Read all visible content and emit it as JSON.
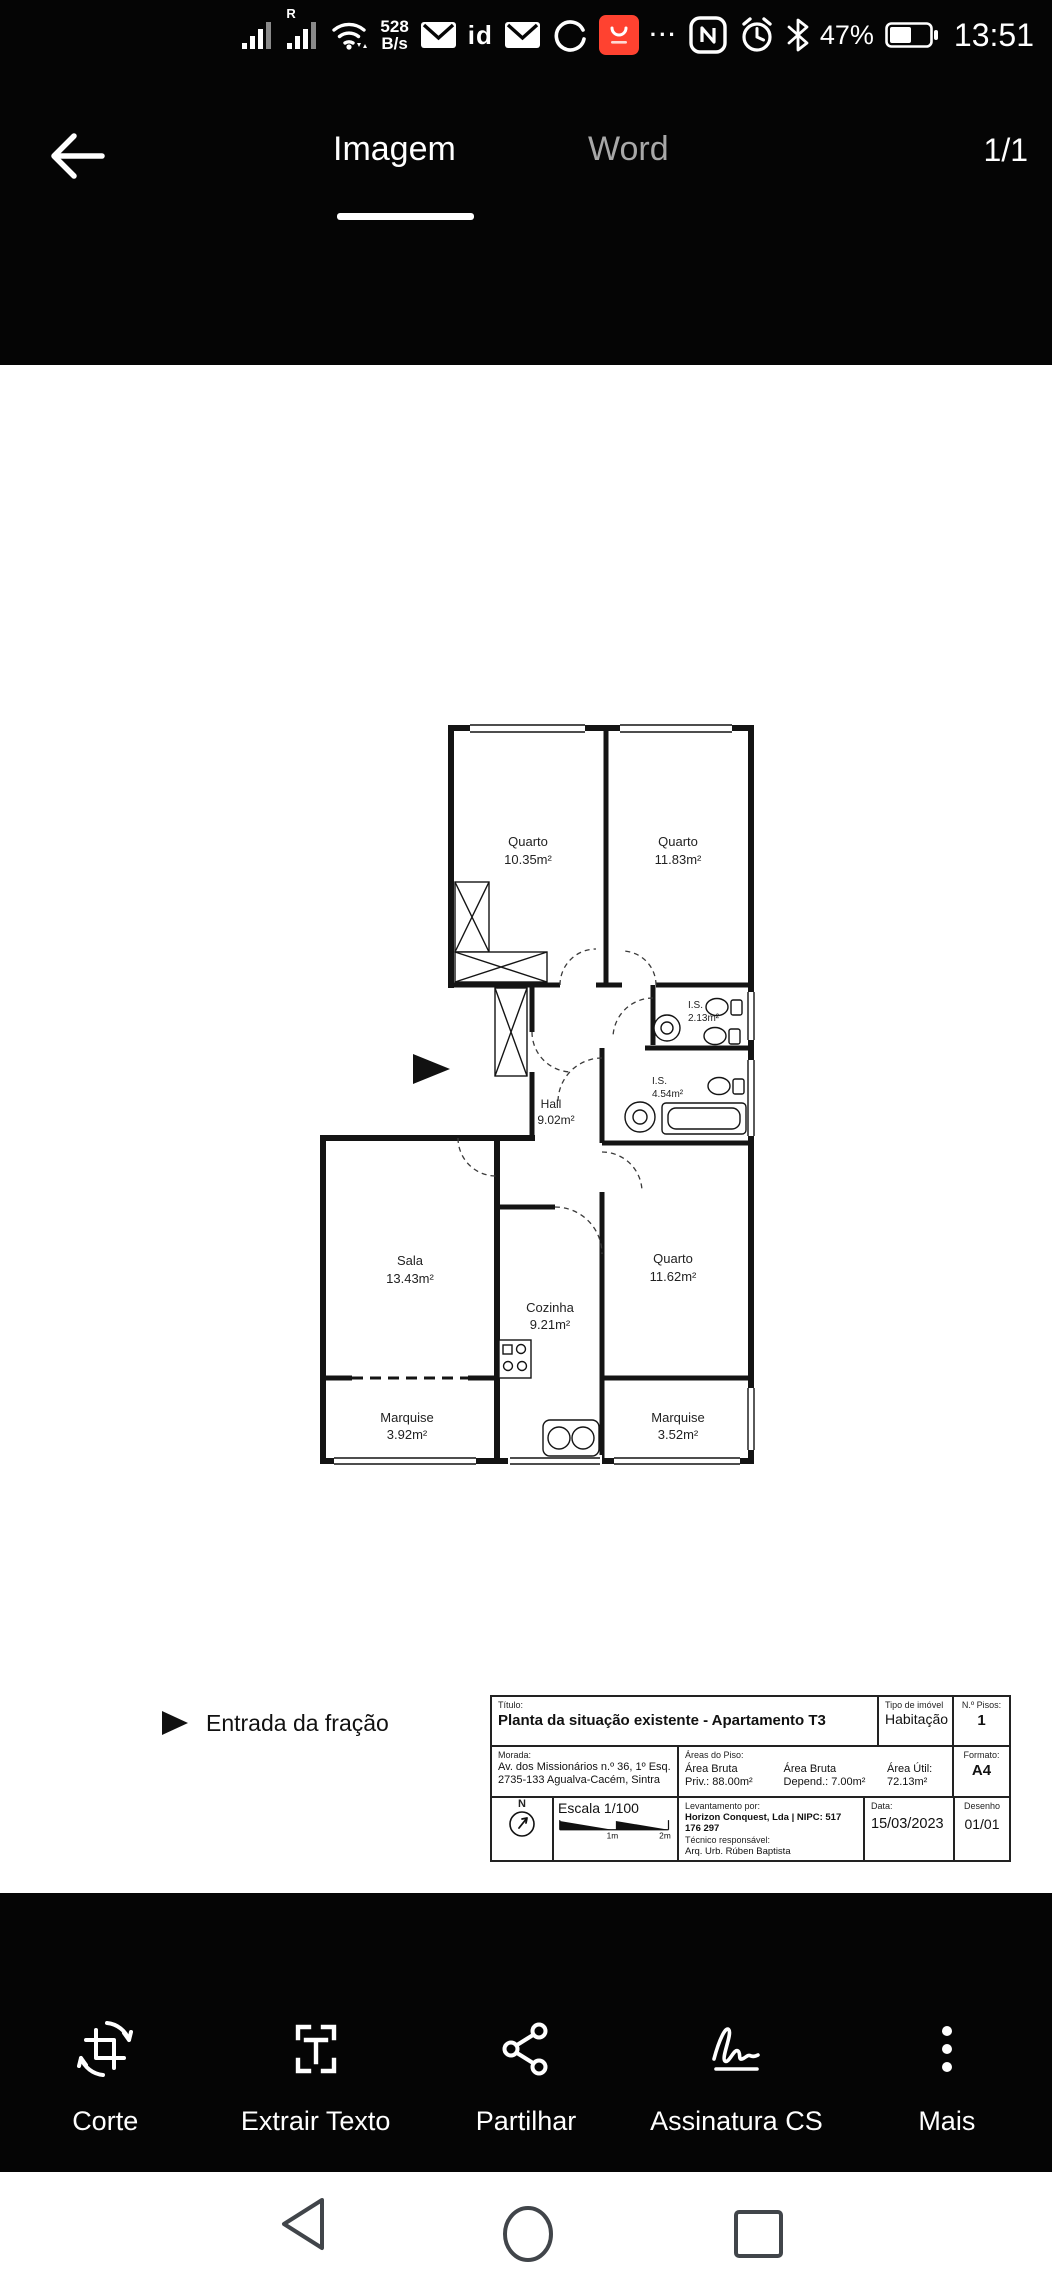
{
  "status_bar": {
    "carrier_indicator": "R",
    "network_speed_value": "528",
    "network_speed_unit": "B/s",
    "id_label": "id",
    "ellipsis": "···",
    "battery_percent": "47%",
    "time": "13:51",
    "aliexpress_color": "#ff4230"
  },
  "header": {
    "tabs": [
      {
        "label": "Imagem",
        "active": true
      },
      {
        "label": "Word",
        "active": false
      }
    ],
    "page_indicator": "1/1"
  },
  "floorplan": {
    "entrance_label": "Entrada da fração",
    "rooms": [
      {
        "name": "Quarto",
        "area": "10.35m²"
      },
      {
        "name": "Quarto",
        "area": "11.83m²"
      },
      {
        "name": "I.S.",
        "area": "2.13m²"
      },
      {
        "name": "I.S.",
        "area": "4.54m²"
      },
      {
        "name": "Hall",
        "area": "9.02m²"
      },
      {
        "name": "Sala",
        "area": "13.43m²"
      },
      {
        "name": "Cozinha",
        "area": "9.21m²"
      },
      {
        "name": "Quarto",
        "area": "11.62m²"
      },
      {
        "name": "Marquise",
        "area": "3.92m²"
      },
      {
        "name": "Marquise",
        "area": "3.52m²"
      }
    ]
  },
  "title_block": {
    "titulo_label": "Título:",
    "titulo": "Planta da situação existente - Apartamento T3",
    "tipo_label": "Tipo de imóvel",
    "tipo": "Habitação",
    "pisos_label": "N.º Pisos:",
    "pisos": "1",
    "morada_label": "Morada:",
    "morada_line1": "Av. dos Missionários n.º 36, 1º Esq.",
    "morada_line2": "2735-133 Agualva-Cacém, Sintra",
    "areas_label": "Áreas do Piso:",
    "area_bruta_priv_l1": "Área Bruta",
    "area_bruta_priv_l2": "Priv.: 88.00m²",
    "area_bruta_dep_l1": "Área Bruta",
    "area_bruta_dep_l2": "Depend.: 7.00m²",
    "area_util_l1": "Área Útil:",
    "area_util_l2": "72.13m²",
    "formato_label": "Formato:",
    "formato": "A4",
    "north_label": "N",
    "escala": "Escala 1/100",
    "scale_1m": "1m",
    "scale_2m": "2m",
    "levantamento_label": "Levantamento por:",
    "levantamento": "Horizon Conquest, Lda | NIPC: 517 176 297",
    "tecnico_label": "Técnico responsável:",
    "tecnico": "Arq. Urb. Rúben Baptista",
    "data_label": "Data:",
    "data": "15/03/2023",
    "desenho_label": "Desenho",
    "desenho": "01/01"
  },
  "toolbar": {
    "items": [
      {
        "label": "Corte"
      },
      {
        "label": "Extrair Texto"
      },
      {
        "label": "Partilhar"
      },
      {
        "label": "Assinatura CS"
      },
      {
        "label": "Mais"
      }
    ]
  }
}
